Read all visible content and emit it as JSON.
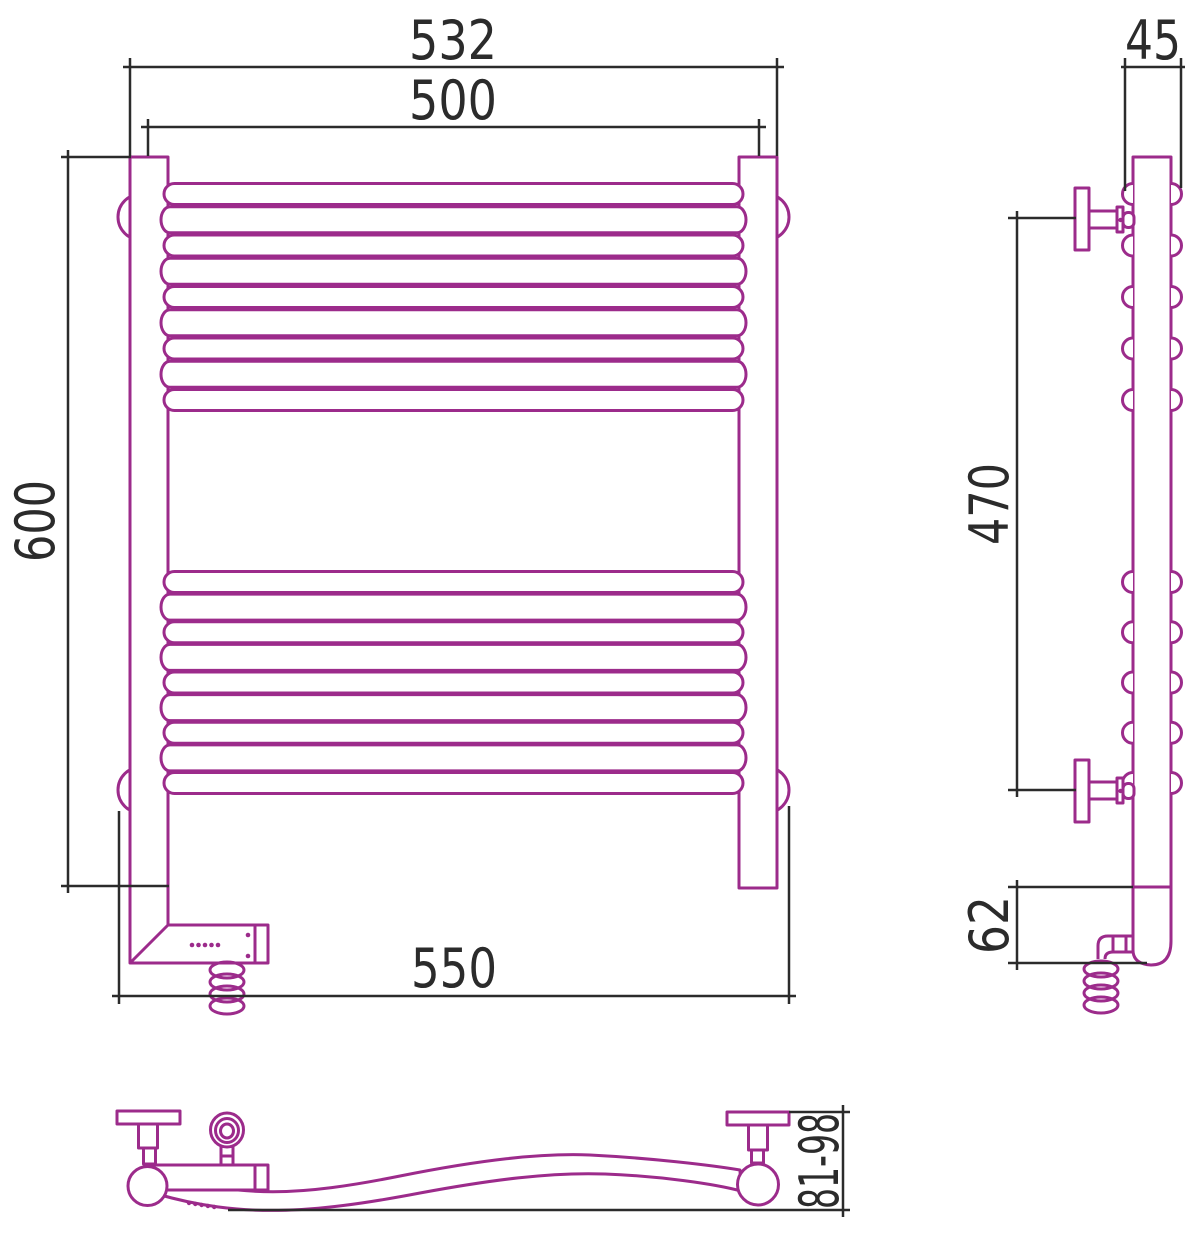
{
  "colors": {
    "product": "#9c2b8b",
    "dimension": "#2b2b2b",
    "background": "#ffffff"
  },
  "dimensions": {
    "front": {
      "overall_width": "532",
      "rail_length": "500",
      "height": "600",
      "mount_width": "550"
    },
    "side": {
      "depth": "45",
      "bracket_span": "470",
      "heater_section_height": "62"
    },
    "top": {
      "wall_clearance": "81-98"
    }
  }
}
